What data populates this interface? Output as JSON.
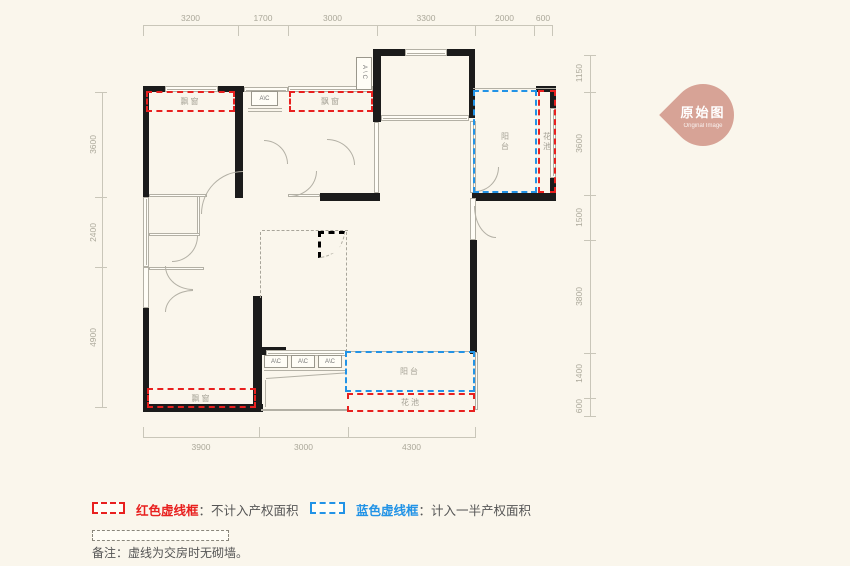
{
  "badge": {
    "title": "原始图",
    "subtitle": "Original Image",
    "color": "#d7a396"
  },
  "dims": {
    "top": [
      "3200",
      "1700",
      "3000",
      "3300",
      "2000",
      "600"
    ],
    "left": [
      "3600",
      "2400",
      "4900"
    ],
    "right": [
      "1150",
      "3600",
      "1500",
      "3800",
      "1400",
      "600"
    ],
    "bottom": [
      "3900",
      "3000",
      "4300"
    ]
  },
  "labels": {
    "bay": "飘窗",
    "balcony": "阳台",
    "flower": "花池",
    "ac": "A\\C"
  },
  "legend": {
    "red_term": "红色虚线框",
    "red_desc": "：不计入产权面积",
    "blue_term": "蓝色虚线框",
    "blue_desc": "：计入一半产权面积",
    "note": "备注：虚线为交房时无砌墙。"
  },
  "colors": {
    "background": "#faf6ec",
    "wall": "#1b1b1b",
    "red_dash": "#e8201f",
    "blue_dash": "#2293e6",
    "badge": "#d7a396"
  }
}
